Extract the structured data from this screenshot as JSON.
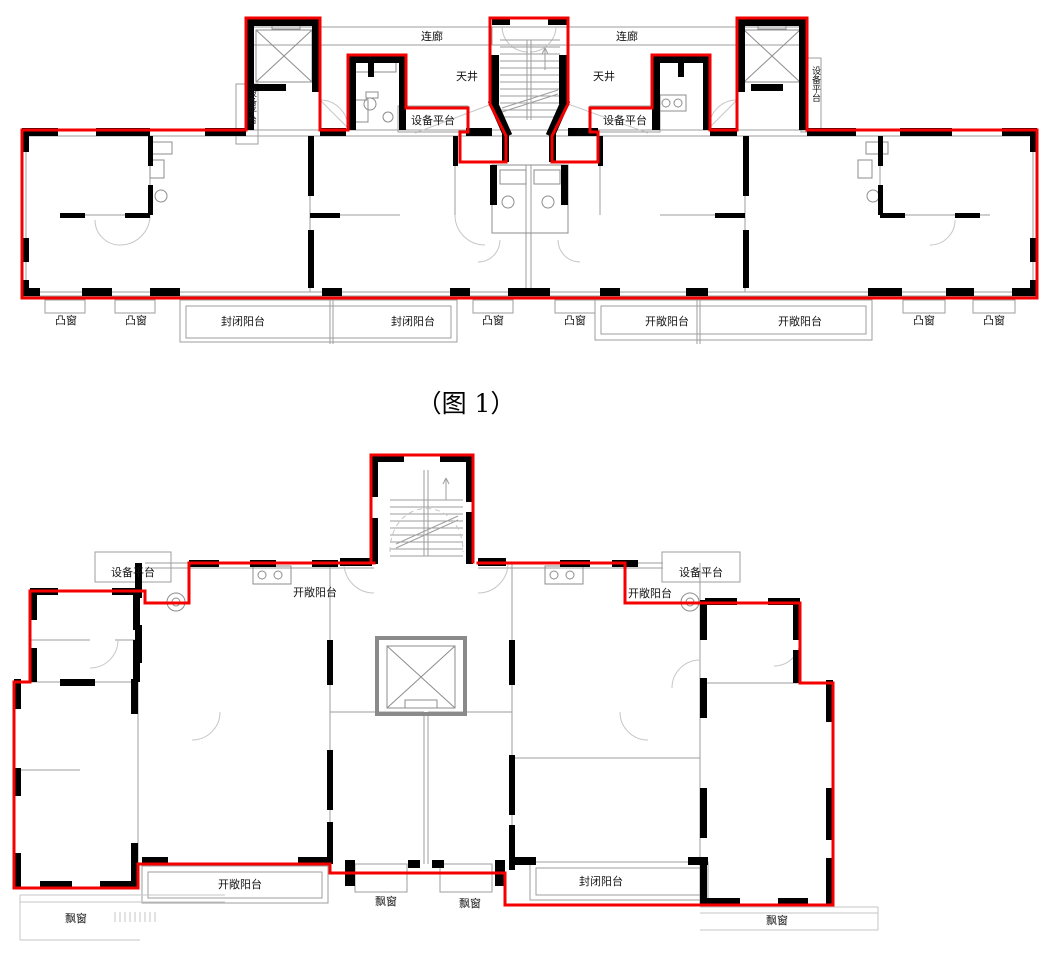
{
  "colors": {
    "outline_red": "#f40000",
    "wall_black": "#000000",
    "line_gray": "#9e9e9e",
    "line_light": "#c6c6c6",
    "label_text": "#141414",
    "background": "#ffffff"
  },
  "caption": {
    "text": "（图 1）"
  },
  "plan1": {
    "labels": {
      "corridor_left": "连廊",
      "corridor_right": "连廊",
      "lightwell_left": "天井",
      "lightwell_right": "天井",
      "equip_left_vertical": "设备平台",
      "equip_right_vertical": "设备平台",
      "equip_left": "设备平台",
      "equip_right": "设备平台",
      "bay_1": "凸窗",
      "bay_2": "凸窗",
      "bay_3": "凸窗",
      "bay_4": "凸窗",
      "bay_5": "凸窗",
      "bay_6": "凸窗",
      "closed_balcony_1": "封闭阳台",
      "closed_balcony_2": "封闭阳台",
      "open_balcony_1": "开敞阳台",
      "open_balcony_2": "开敞阳台"
    }
  },
  "plan2": {
    "labels": {
      "equip_left": "设备平台",
      "equip_right": "设备平台",
      "open_balcony_top_left": "开敞阳台",
      "open_balcony_top_right": "开敞阳台",
      "open_balcony_bottom": "开敞阳台",
      "closed_balcony_bottom": "封闭阳台",
      "bay_left": "飘窗",
      "bay_mid_1": "飘窗",
      "bay_mid_2": "飘窗",
      "bay_right": "飘窗"
    }
  }
}
